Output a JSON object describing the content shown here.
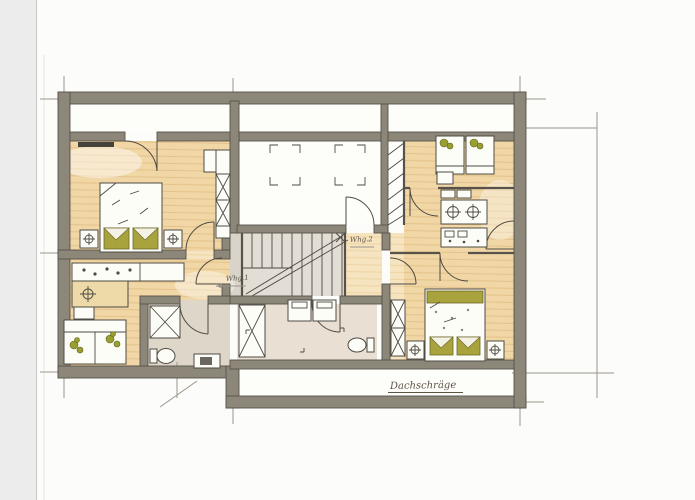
{
  "document": {
    "kind": "scanned hand-drawn floor plan",
    "language": "German"
  },
  "labels": {
    "apartment_1": "Whg.1",
    "apartment_2": "Whg.2",
    "roof_slope": "Dachschräge"
  },
  "palette": {
    "wall": "#8d8779",
    "wall_edge": "#57534a",
    "pencil": "#9b958a",
    "line": "#4f4b43",
    "white": "#fdfdf8",
    "wood": "#f2d7a6",
    "wood_stripe": "#e3c38c",
    "wood_light": "#f6e3bf",
    "wood_light_stripe": "#ecd4a4",
    "tile": "#ddd6c9",
    "laundry_floor": "#e9dfd2",
    "stair_floor": "#e2ded5",
    "landing_floor": "#d9d4ca",
    "olive": "#a8a33c",
    "scan_band": "#ececec"
  },
  "symbols": {
    "faucet_icon": "circle with cross (sink / basin tap)",
    "lamp_icon": "circle with cross on nightstand",
    "wardrobe_icon": "rectangle with X",
    "shower_icon": "square with X",
    "stairs_icon": "treads with diagonal break line",
    "door_icon": "quarter-circle swing arc",
    "skylight_icon": "corner tick rectangle",
    "washing_machine_icon": "square with inset door rectangle",
    "toilet_icon": "oval bowl with cistern"
  }
}
